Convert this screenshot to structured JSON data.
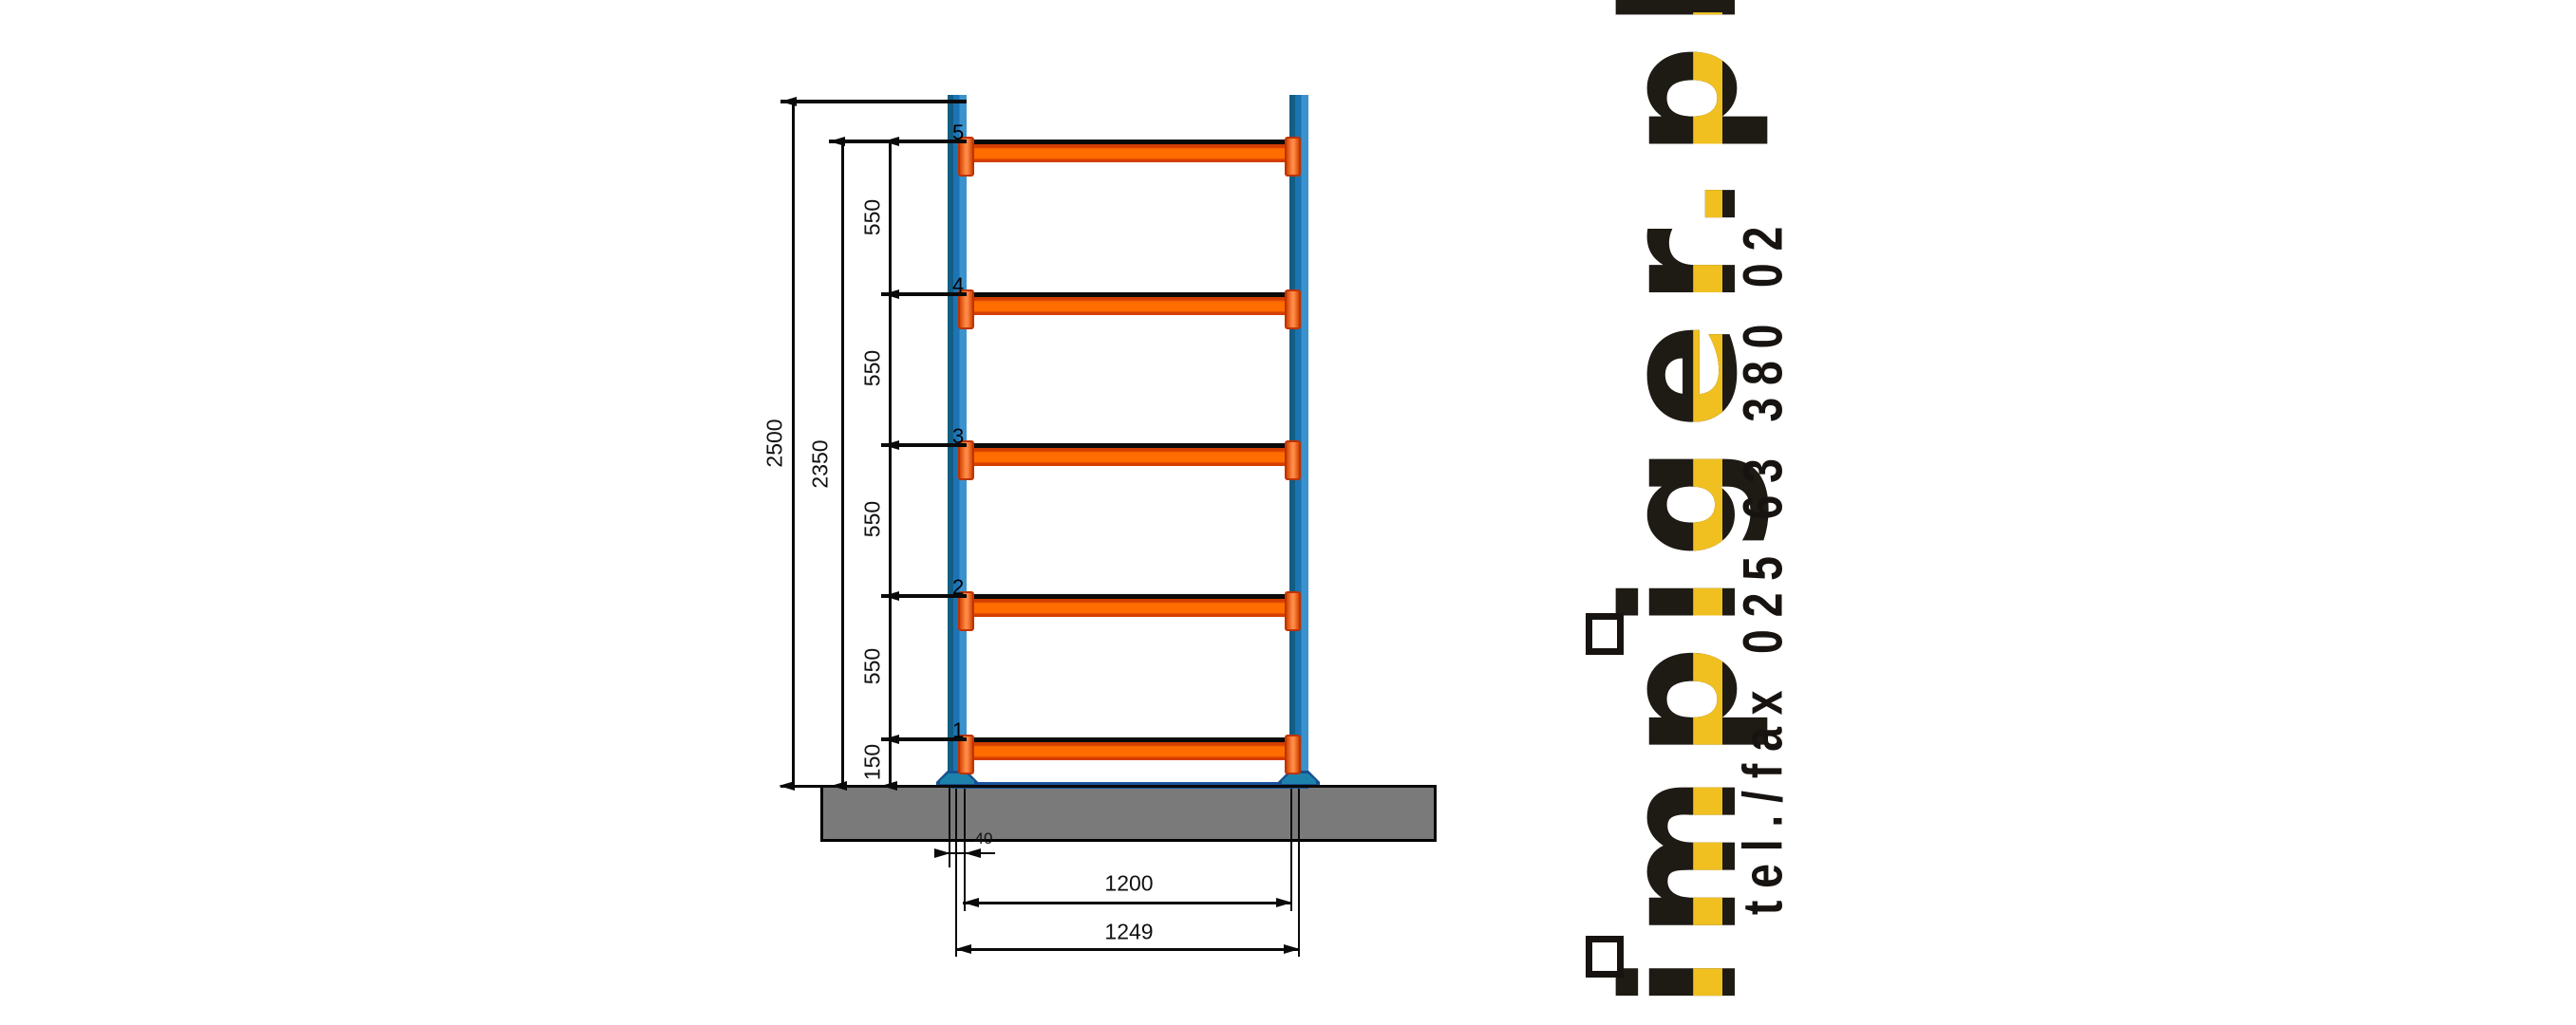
{
  "drawing": {
    "title_hint": "pallet-rack front elevation drawing",
    "left_dims": {
      "total_height": "2500",
      "to_top_beam": "2350",
      "spacings": [
        "550",
        "550",
        "550",
        "550"
      ],
      "first_level": "150"
    },
    "bottom_dims": {
      "post_width": "40",
      "beam_span": "1200",
      "overall_width": "1249"
    },
    "beam_numbers": [
      "5",
      "4",
      "3",
      "2",
      "1"
    ],
    "colors": {
      "post_blue": "#1D74B4",
      "post_blue_dark": "#135E84",
      "post_blue_light": "#3B92CC",
      "beam_orange": "#FF6C00",
      "beam_orange_dark": "#D43E00",
      "base_blue": "#1A55A0",
      "foot_teal": "#1E83AC",
      "slab_gray": "#7A7A7A",
      "line_black": "#0a0a0a"
    }
  },
  "branding": {
    "logo_text": "impiger.pl",
    "phone": "tel./fax 025 63 380 02",
    "logo_black": "#1E1A14",
    "logo_yellow": "#F0C020"
  }
}
